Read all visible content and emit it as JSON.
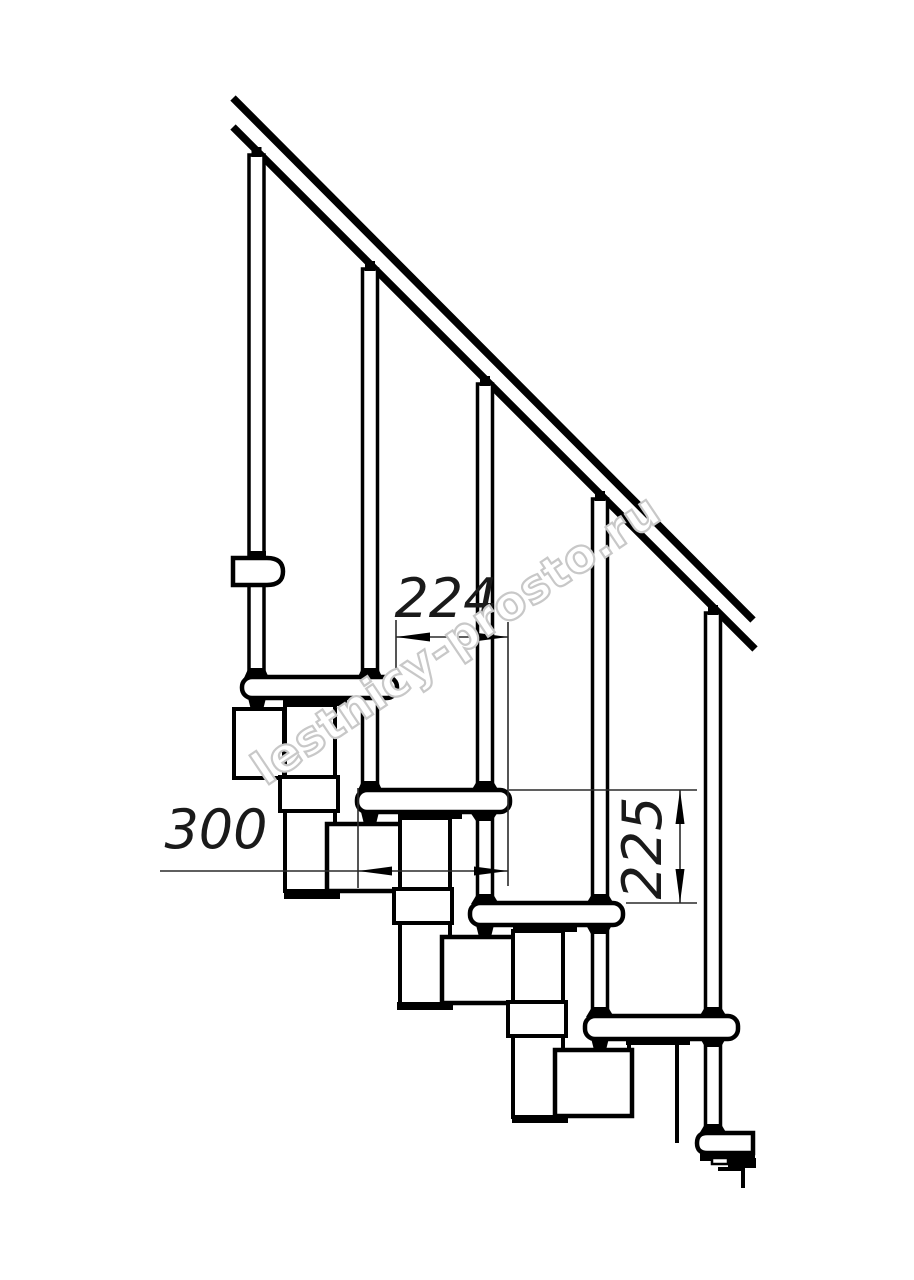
{
  "page": {
    "background": "#ffffff"
  },
  "drawing": {
    "kind": "staircase-side-view-technical-drawing",
    "line_color": "#000000",
    "steps_count": 5,
    "balusters_count": 5,
    "dimensions": [
      {
        "id": "dim-224",
        "value": "224",
        "orientation": "horizontal"
      },
      {
        "id": "dim-300",
        "value": "300",
        "orientation": "horizontal"
      },
      {
        "id": "dim-225",
        "value": "225",
        "orientation": "vertical"
      }
    ],
    "watermark": {
      "text": "lestnicy-prosto.ru",
      "color": "#c8c8c8"
    }
  }
}
